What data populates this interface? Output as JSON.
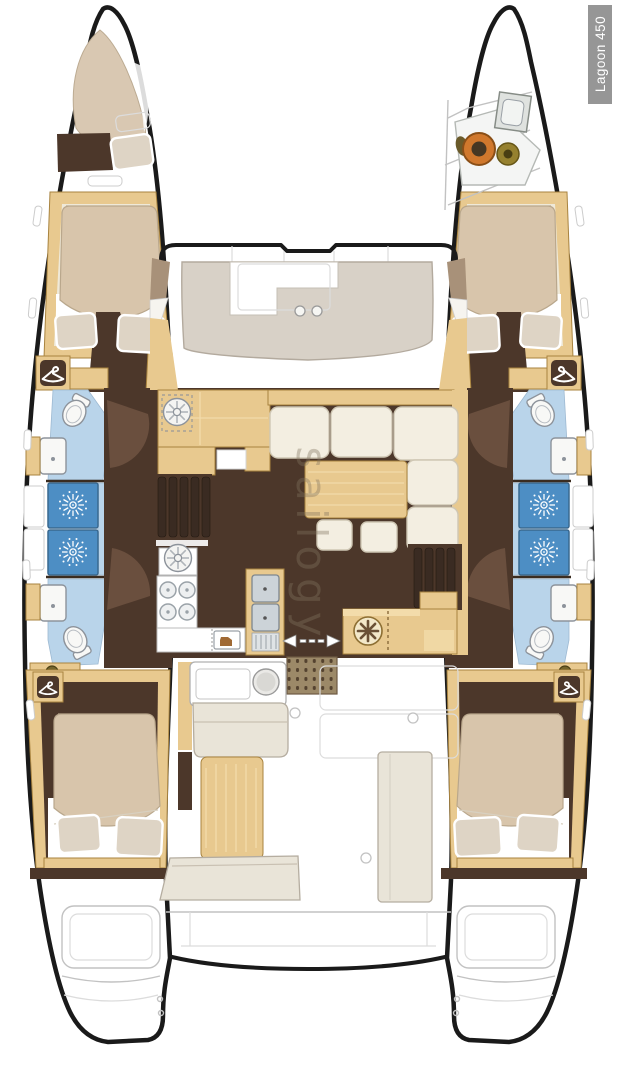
{
  "image": {
    "type": "catamaran-floor-plan",
    "view": "top-down deck plan"
  },
  "labels": {
    "model_badge": "Lagoon 450",
    "watermark": "sailogy"
  },
  "icons": {
    "shower": "starburst-shower-rose",
    "wardrobe": "clothes-hanger",
    "toilet": "wc-bowl-with-tank",
    "washbasin": "square-basin-with-drain",
    "stove": "four-burner-hob",
    "galley_sink": "round-sink-with-petals",
    "double_sink": "twin-steel-sinks-with-drainer",
    "icebox": "front-loading-cooler",
    "sliding_door": "double-headed-dashed-arrow",
    "windlass": "orange-winch-drum",
    "cockpit_grate": "teak-dot-grate"
  },
  "colors": {
    "hull_outline": "#1a1a1a",
    "wood": "#e8c98f",
    "wood_light": "#f3dcab",
    "wood_edge": "#a8833f",
    "floor_dark": "#4c372a",
    "floor_wedge": "#6a4f3e",
    "bed_duvet": "#d8c5ab",
    "mattress": "#efe9d8",
    "pillow": "#ded4c5",
    "settee": "#d8d1c7",
    "sofa": "#f3eee1",
    "bench": "#e9e4d8",
    "bath_floor": "#b9d4ea",
    "shower_blue": "#4d8ec4",
    "grate": "#9c8968",
    "grate_dot": "#54422f",
    "stair_dark": "#3a2b22",
    "windlass_orange": "#d0782d",
    "bronze": "#96812f",
    "label_bg": "#969696",
    "label_text": "#ffffff",
    "line_gray": "#c2c2c2",
    "watermark_color": "rgba(130,115,95,0.38)"
  }
}
